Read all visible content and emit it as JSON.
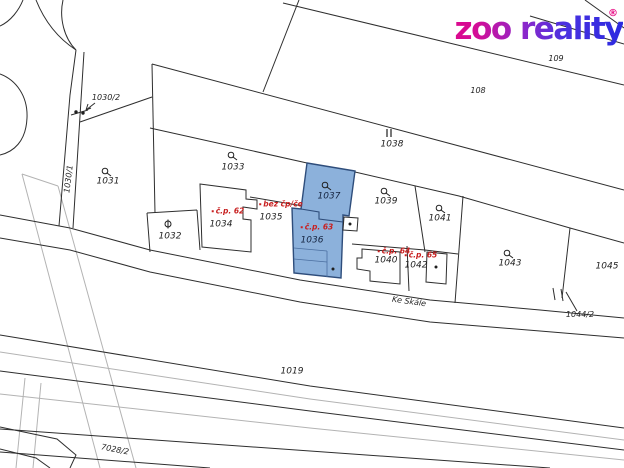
{
  "logo": {
    "text": "zoo reality",
    "registered": "®"
  },
  "colors": {
    "highlight_fill": "#82aad8",
    "highlight_stroke": "#2e4d7b",
    "red_label": "#c82020",
    "map_line": "#2e2e2e",
    "gray_line": "#b3b3b3"
  },
  "street": {
    "name": "Ke Skále"
  },
  "highlighted_parcels": [
    "1037",
    "1036"
  ],
  "labels": {
    "l109": "109",
    "l108": "108",
    "l1038": "1038",
    "l1030_2": "1030/2",
    "l1030_1": "1030/1",
    "l1031": "1031",
    "l1032": "1032",
    "l1033": "1033",
    "l1034": "1034",
    "l1035": "1035",
    "l1036": "1036",
    "l1037": "1037",
    "l1039": "1039",
    "l1040": "1040",
    "l1041": "1041",
    "l1042": "1042",
    "l1043": "1043",
    "l1045": "1045",
    "l1044_2": "1044/2",
    "l1019": "1019",
    "l7028_2": "7028/2"
  },
  "red_labels": {
    "cp62": "č.p. 62",
    "bez": "bez čp/če",
    "cp63": "č.p. 63",
    "cp64": "č.p. 64",
    "cp65": "č.p. 65"
  }
}
